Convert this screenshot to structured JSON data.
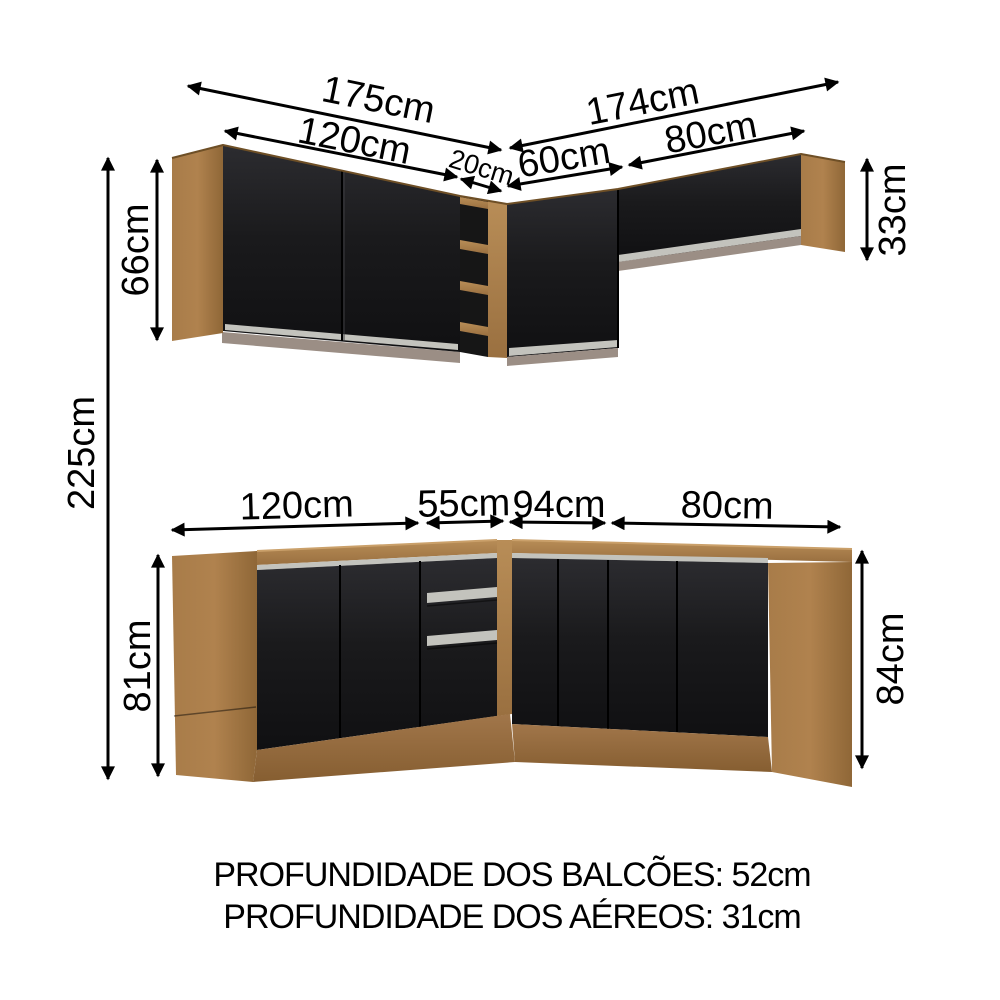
{
  "diagram": {
    "title": "kitchen corner cabinet dimensions",
    "upper": {
      "total_left": "175cm",
      "left_doors": "120cm",
      "corner_shelf": "20cm",
      "total_right": "174cm",
      "corner_door": "60cm",
      "right_cabinet": "80cm",
      "left_height": "66cm",
      "right_height": "33cm"
    },
    "overall_height": "225cm",
    "lower": {
      "left_doors": "120cm",
      "corner_left": "55cm",
      "corner_right": "94cm",
      "right_doors": "80cm",
      "left_height": "81cm",
      "right_height": "84cm"
    },
    "footer": {
      "line1": "PROFUNDIDADE DOS BALCÕES: 52cm",
      "line2": "PROFUNDIDADE DOS AÉREOS: 31cm"
    },
    "colors": {
      "wood": "#ab7f4b",
      "wood_dark": "#9a7040",
      "wood_light": "#b58a55",
      "door_black": "#1b1b1d",
      "rail_silver": "#c3c3bd",
      "underside_shadow": "#9b8e85",
      "shelf_interior": "#161616",
      "annotation": "#000000",
      "background": "#ffffff"
    }
  }
}
